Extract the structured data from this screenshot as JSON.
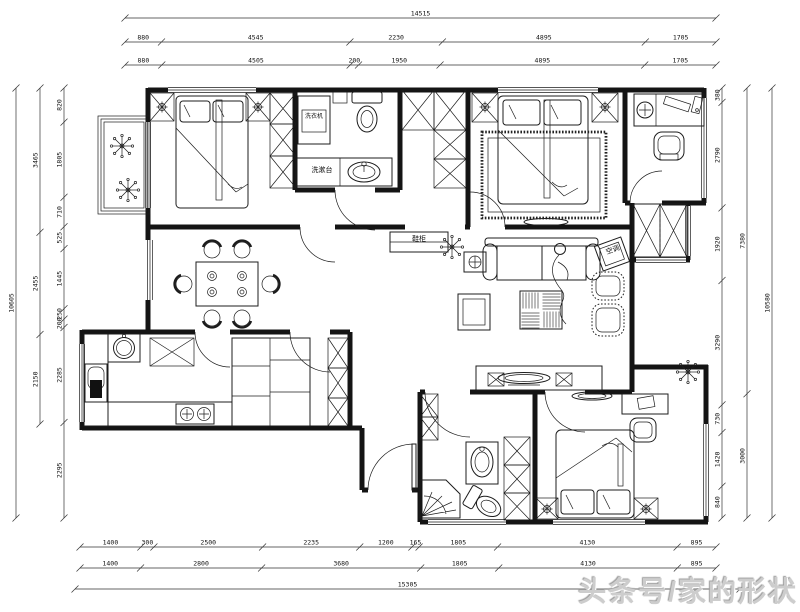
{
  "title": "apartment-floor-plan",
  "watermark": "头条号/家的形状",
  "plan_labels": {
    "washing_machine": "洗衣机",
    "wash_counter": "洗漱台",
    "shoe_cabinet": "鞋柜",
    "air_conditioner": "空调"
  },
  "dimensions": {
    "top": {
      "total": "14515",
      "row1": [
        "880",
        "4545",
        "2230",
        "4895",
        "1705"
      ],
      "row2": [
        "880",
        "4505",
        "200",
        "1950",
        "4895",
        "1705"
      ]
    },
    "left": {
      "total": "10605",
      "middle": [
        "3465",
        "2455",
        "2150"
      ],
      "inner": [
        "820",
        "1805",
        "710",
        "525",
        "1445",
        "250",
        "200",
        "2285",
        "2295"
      ]
    },
    "right": {
      "inner": [
        "380",
        "2790",
        "1920",
        "3290",
        "730",
        "1420",
        "840"
      ],
      "middle": [
        "7380",
        "3000"
      ],
      "total": "10580"
    },
    "bottom": {
      "row1": [
        "1400",
        "300",
        "2500",
        "2235",
        "1200",
        "165",
        "1805",
        "4130",
        "895"
      ],
      "row2": [
        "1400",
        "2800",
        "3680",
        "1805",
        "4130",
        "895"
      ],
      "total": "15305"
    }
  }
}
